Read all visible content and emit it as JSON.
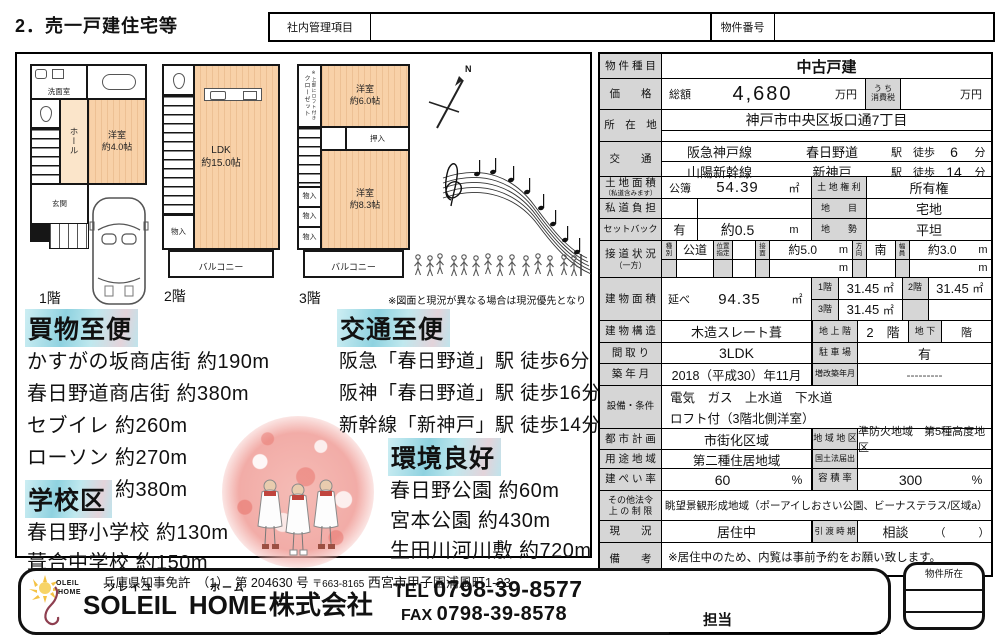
{
  "colors": {
    "room_fill": "#f8d1a8",
    "header_highlight": "#8fd2e0",
    "table_label_bg": "#d6d6d6"
  },
  "header": {
    "page_title": "2．売一戸建住宅等",
    "internal_box_label": "社内管理項目",
    "property_no_label": "物件番号"
  },
  "floorplans": {
    "disclaimer": "※図面と現況が異なる場合は現況優先となります。",
    "compass_label": "N",
    "floor1": {
      "label": "1階",
      "senmen": "洗面室",
      "hall": "ホール",
      "room_name": "洋室",
      "room_size": "約4.0帖",
      "genkan": "玄関"
    },
    "floor2": {
      "label": "2階",
      "ldk_name": "LDK",
      "ldk_size": "約15.0帖",
      "monoire": "物入",
      "balcony": "バルコニー"
    },
    "floor3": {
      "label": "3階",
      "closet": "クローゼット",
      "closet_note": "※上部にロフト付き",
      "room1_name": "洋室",
      "room1_size": "約6.0帖",
      "oshiire": "押入",
      "monoire": "物入",
      "room2_name": "洋室",
      "room2_size": "約8.3帖",
      "balcony": "バルコニー"
    }
  },
  "sections": {
    "shopping": {
      "title": "買物至便",
      "items": [
        "かすがの坂商店街 約190m",
        "春日野道商店街 約380m",
        "セブイレ 約260m",
        "ローソン 約270m",
        "ファミマ 約380m"
      ]
    },
    "transport": {
      "title": "交通至便",
      "items": [
        "阪急「春日野道」駅 徒歩6分",
        "阪神「春日野道」駅 徒歩16分",
        "新幹線「新神戸」駅 徒歩14分"
      ]
    },
    "school": {
      "title": "学校区",
      "items": [
        "春日野小学校 約130m",
        "葺合中学校 約150m"
      ]
    },
    "environment": {
      "title": "環境良好",
      "items": [
        "春日野公園 約60m",
        "宮本公園 約430m",
        "生田川河川敷 約720m"
      ]
    }
  },
  "table": {
    "type_label": "物 件 種 目",
    "type": "中古戸建",
    "price_label": "価　　格",
    "price_prefix": "総額",
    "price": "4,680",
    "price_unit": "万円",
    "tax_label": "う ち\n消費税",
    "tax_unit": "万円",
    "location_label": "所　在　地",
    "location": "神戸市中央区坂口通7丁目",
    "access_label": "交　　通",
    "access1_line": "阪急神戸線",
    "access1_station": "春日野道",
    "access1_walk": "駅　徒歩",
    "access1_min": "6",
    "access1_unit": "分",
    "access2_line": "山陽新幹線",
    "access2_station": "新神戸",
    "access2_walk": "駅　徒歩",
    "access2_min": "14",
    "access2_unit": "分",
    "land_label": "土 地 面 積",
    "land_sub": "（私道含みます）",
    "land_kobo": "公簿",
    "land_value": "54.39",
    "land_unit": "㎡",
    "land_right_label": "土 地 権 利",
    "land_right": "所有権",
    "road_burden_label": "私 道 負 担",
    "chimoku_label": "地　　目",
    "chimoku": "宅地",
    "setback_label": "セットバック",
    "setback_has": "有",
    "setback_value": "約0.5",
    "setback_unit": "m",
    "chisei_label": "地　　勢",
    "chisei": "平坦",
    "road_label": "接 道 状 況",
    "road_sub": "（一方）",
    "road_kind_label": "種\n別",
    "road_kind": "公道",
    "road_pos_label": "位置\n指定",
    "road_face_label": "接\n面",
    "road_face": "約5.0",
    "road_face_unit": "m",
    "road_dir_label": "方\n向",
    "road_dir": "南",
    "road_width_label": "幅\n員",
    "road_width": "約3.0",
    "road_width_unit": "m",
    "barea_label": "建 物 面 積",
    "barea_nobe": "延べ",
    "barea_value": "94.35",
    "barea_unit": "㎡",
    "f1_label": "1階",
    "f1": "31.45",
    "f2_label": "2階",
    "f2": "31.45",
    "f3_label": "3階",
    "f3": "31.45",
    "floor_unit": "㎡",
    "structure_label": "建 物 構 造",
    "structure": "木造スレート葺",
    "above_label": "地 上 階",
    "above": "2　階",
    "below_label": "地 下",
    "below": "階",
    "madori_label": "間 取 り",
    "madori": "3LDK",
    "parking_label": "駐 車 場",
    "parking": "有",
    "built_label": "築 年 月",
    "built": "2018（平成30）年11月",
    "renov_label": "増改築年月",
    "renov": "---------",
    "setsubi_label": "設備・条件",
    "setsubi1": "電気　ガス　上水道　下水道",
    "setsubi2": "ロフト付（3階北側洋室）",
    "cityplan_label": "都 市 計 画",
    "cityplan": "市街化区域",
    "district_label": "地 域 地 区",
    "district": "準防火地域　第5種高度地区",
    "use_label": "用 途 地 域",
    "use": "第二種住居地域",
    "kokudo_label": "国土法届出",
    "kenpei_label": "建 ぺ い 率",
    "kenpei": "60",
    "kenpei_unit": "%",
    "yoseki_label": "容 積 率",
    "yoseki": "300",
    "yoseki_unit": "%",
    "other_label": "その他法令\n上 の 制 限",
    "other": "眺望景観形成地域（ポーアイしおさい公園、ビーナステラス/区域a）",
    "status_label": "現　　況",
    "status": "居住中",
    "handover_label": "引 渡 時 期",
    "handover": "相談",
    "handover_paren": "（　　　）",
    "remarks_label": "備　　考",
    "remarks": "※居住中のため、内覧は事前予約をお願い致します。"
  },
  "footer": {
    "license": "兵庫県知事免許　（1）　第 204630 号",
    "postal": "〒663-8165",
    "address": "西宮市甲子園浦風町1-23",
    "furigana1": "ソレイユ",
    "name1": "SOLEIL",
    "furigana2": "ホーム",
    "name2": "HOME",
    "suffix": "株式会社",
    "tel_label": "TEL",
    "tel": "0798-39-8577",
    "fax_label": "FAX",
    "fax": "0798-39-8578",
    "staff_label": "担当",
    "logo_line1": "OLEIL",
    "logo_line2": "HOME",
    "location_box_label": "物件所在"
  }
}
